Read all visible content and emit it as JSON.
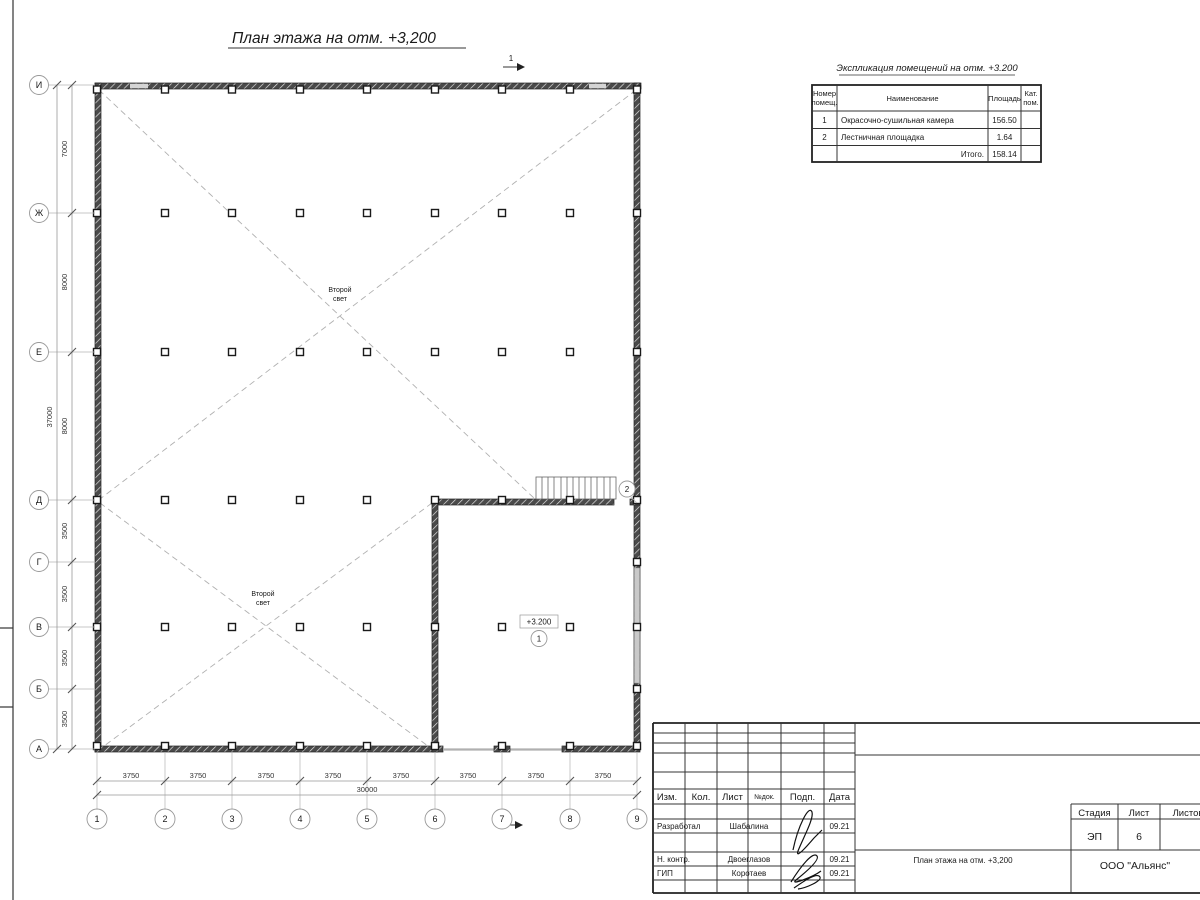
{
  "title": "План этажа на отм. +3,200",
  "plan": {
    "section_mark": "1",
    "axes_left": [
      "И",
      "Ж",
      "Е",
      "Д",
      "Г",
      "В",
      "Б",
      "А"
    ],
    "axes_bottom": [
      "1",
      "2",
      "3",
      "4",
      "5",
      "6",
      "7",
      "8",
      "9"
    ],
    "dims_left": [
      "7000",
      "8000",
      "8000",
      "3500",
      "3500",
      "3500",
      "3500"
    ],
    "dim_left_total": "37000",
    "dims_bottom": [
      "3750",
      "3750",
      "3750",
      "3750",
      "3750",
      "3750",
      "3750",
      "3750"
    ],
    "dim_bottom_total": "30000",
    "second_light_line1": "Второй",
    "second_light_line2": "свет",
    "elevation": "+3.200",
    "room1": "1",
    "room2": "2"
  },
  "schedule": {
    "title": "Экспликация помещений на отм. +3.200",
    "headers": {
      "number_1": "Номер",
      "number_2": "помещ.",
      "name": "Наименование",
      "area": "Площадь",
      "cat_1": "Кат.",
      "cat_2": "пом."
    },
    "rows": [
      {
        "number": "1",
        "name": "Окрасочно-сушильная камера",
        "area": "156.50"
      },
      {
        "number": "2",
        "name": "Лестничная площадка",
        "area": "1.64"
      }
    ],
    "total_label": "Итого.",
    "total_value": "158.14"
  },
  "title_block": {
    "columns": [
      "Изм.",
      "Кол.",
      "Лист",
      "№док.",
      "Подп.",
      "Дата"
    ],
    "rows": [
      {
        "role": "Разработал",
        "name": "Шабалина",
        "date": "09.21"
      },
      {
        "role": "Н. контр.",
        "name": "Двоеглазов",
        "date": "09.21"
      },
      {
        "role": "ГИП",
        "name": "Коротаев",
        "date": "09.21"
      }
    ],
    "stage_label": "Стадия",
    "sheet_label": "Лист",
    "sheets_label": "Листов",
    "stage": "ЭП",
    "sheet": "6",
    "doc_title": "План этажа на отм. +3,200",
    "company": "ООО \"Альянс\""
  }
}
